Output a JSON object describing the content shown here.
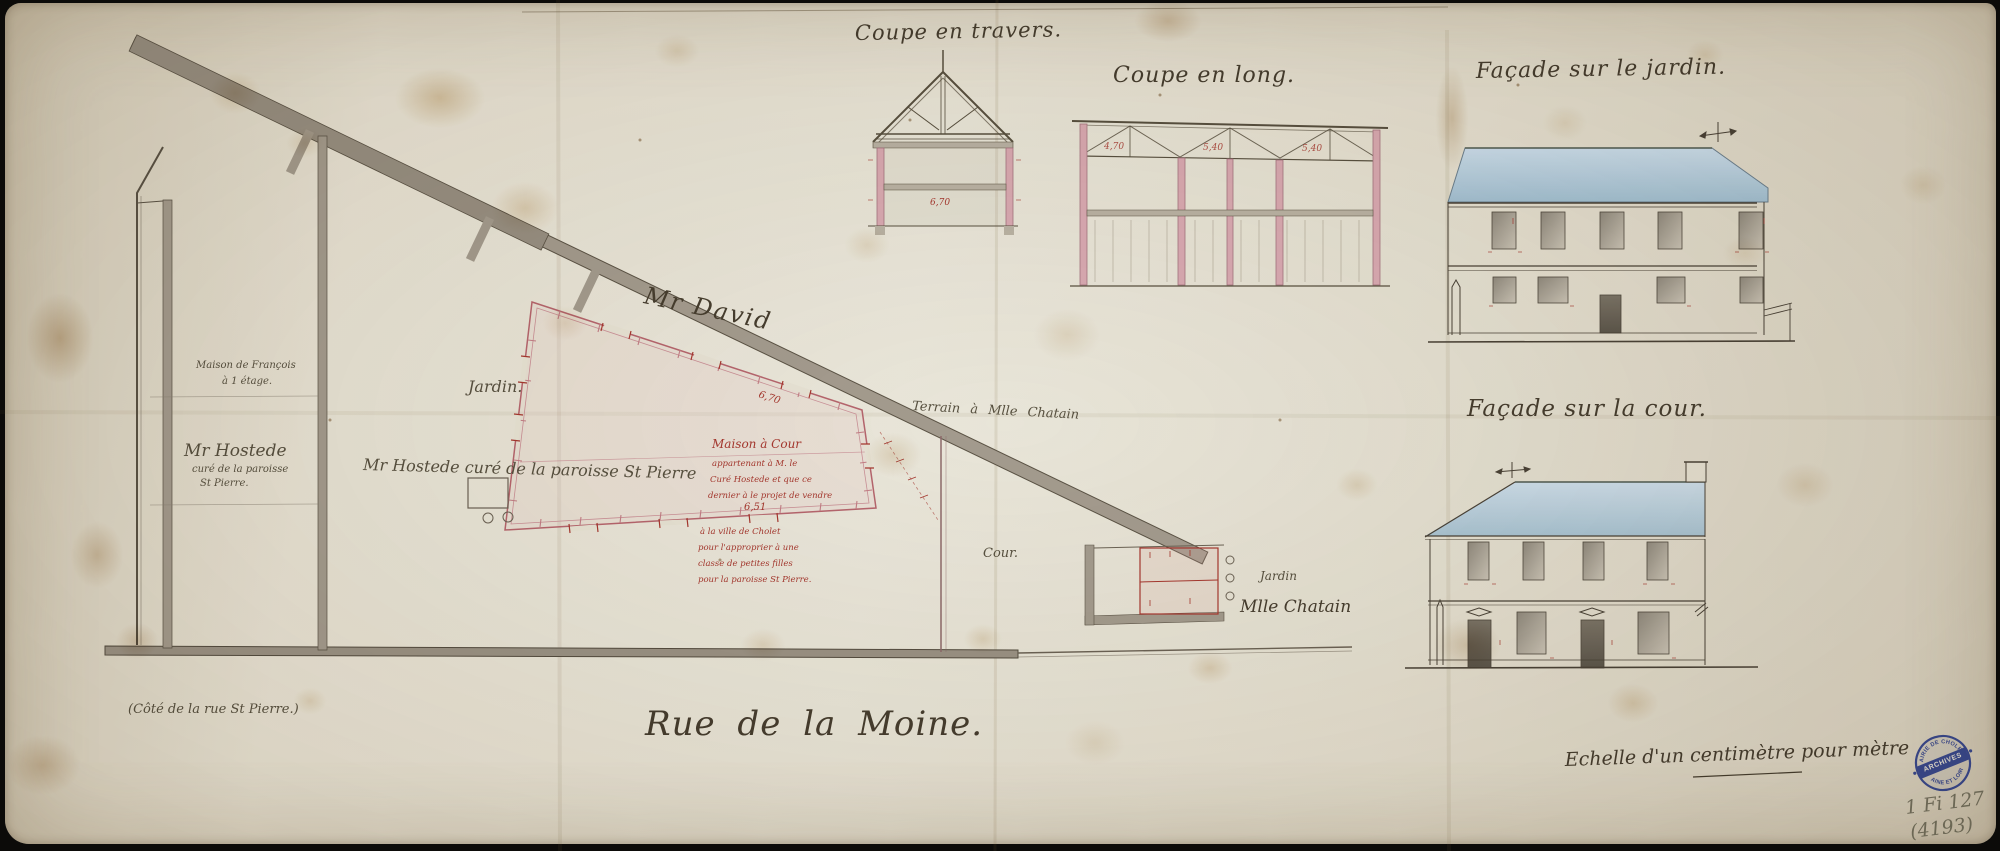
{
  "titles": {
    "transverse": "Coupe en travers.",
    "longitudinal": "Coupe en long.",
    "garden_facade": "Façade sur le jardin.",
    "courtyard_facade": "Façade sur la cour."
  },
  "plan": {
    "neighbor_top": "Mr David",
    "garden": "Jardin.",
    "parcel": "Mr Hostede curé de la paroisse St Pierre",
    "left_block_top_1": "Maison de François",
    "left_block_top_2": "à 1 étage.",
    "left_block_bottom_1": "Mr Hostede",
    "left_block_bottom_2": "curé de la paroisse",
    "left_block_bottom_3": "St Pierre.",
    "terrain": "Terrain à Mlle Chatain",
    "cour": "Cour.",
    "jardin_right": "Jardin",
    "jardin_right_owner": "Mlle Chatain",
    "street": "Rue de la Moine.",
    "side_note": "(Côté de la rue St Pierre.)",
    "red_note": {
      "upper": [
        "Maison à Cour",
        "appartenant à M. le",
        "Curé Hostede et que ce",
        "dernier à le projet de vendre"
      ],
      "lower": [
        "à la ville de Cholet",
        "pour l'approprier à une",
        "classe de petites filles",
        "pour la paroisse St Pierre."
      ]
    }
  },
  "dims": {
    "plan_top": "6,70",
    "plan_mid": "6,51",
    "travers": "6,70",
    "long": [
      "4,70",
      "5,40",
      "5,40"
    ]
  },
  "notes": {
    "scale": "Echelle d'un centimètre pour mètre"
  },
  "stamp": {
    "top": "MAIRIE DE CHOLET",
    "middle": "ARCHIVES",
    "bottom": "MAINE ET LOIRE"
  },
  "ref": {
    "line1": "1 Fi 127",
    "line2": "(4193)"
  },
  "colors": {
    "ink": "#4a4236",
    "red_ink": "#a5372e",
    "roof_blue": "#b4cbdc",
    "wall_pink": "#d8a9b2",
    "wall_gray": "#a39b8e",
    "stamp_blue": "#2d3e8c",
    "pencil": "#73705e"
  }
}
